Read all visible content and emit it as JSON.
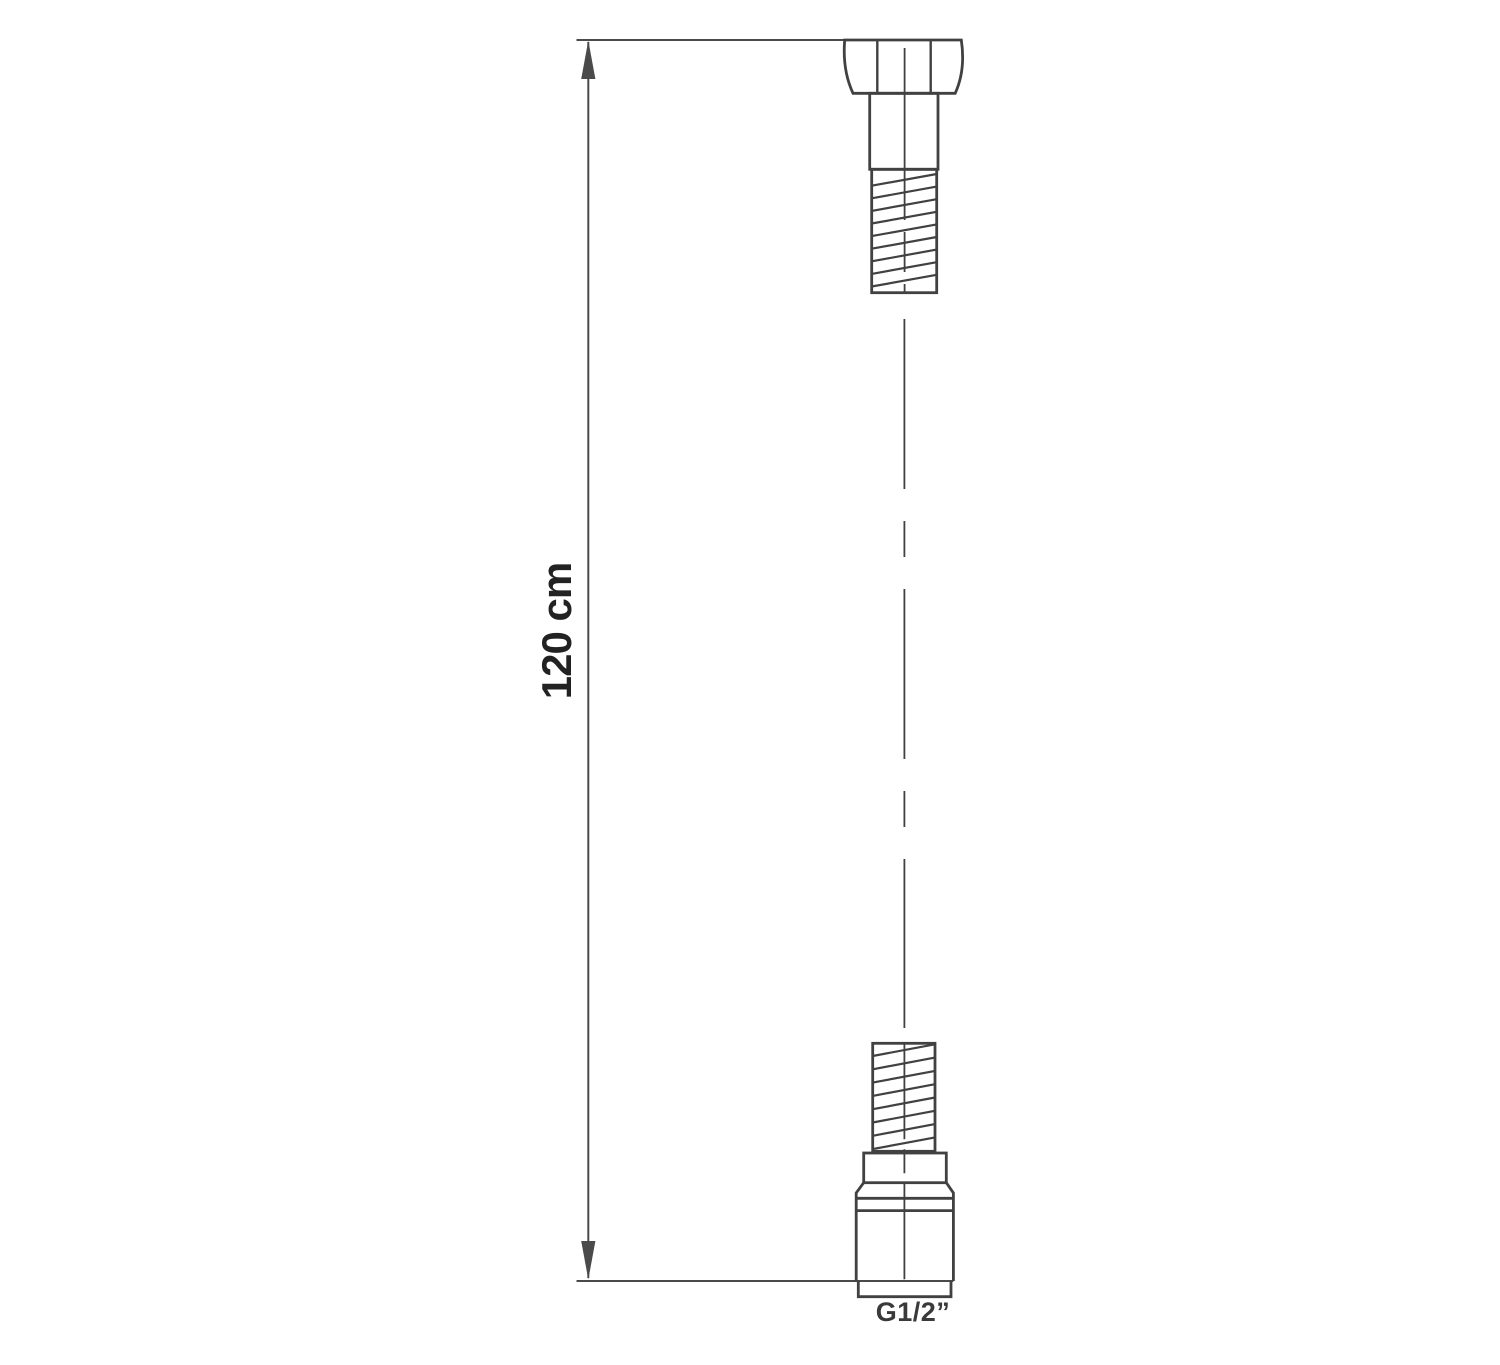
{
  "page": {
    "background": "#ffffff"
  },
  "colors": {
    "line": "#414141",
    "dim": "#4a4a4a",
    "ink": "#222222"
  },
  "drawing": {
    "dimension": {
      "label": "120 cm"
    },
    "thread": {
      "label": "G1/2”"
    }
  }
}
